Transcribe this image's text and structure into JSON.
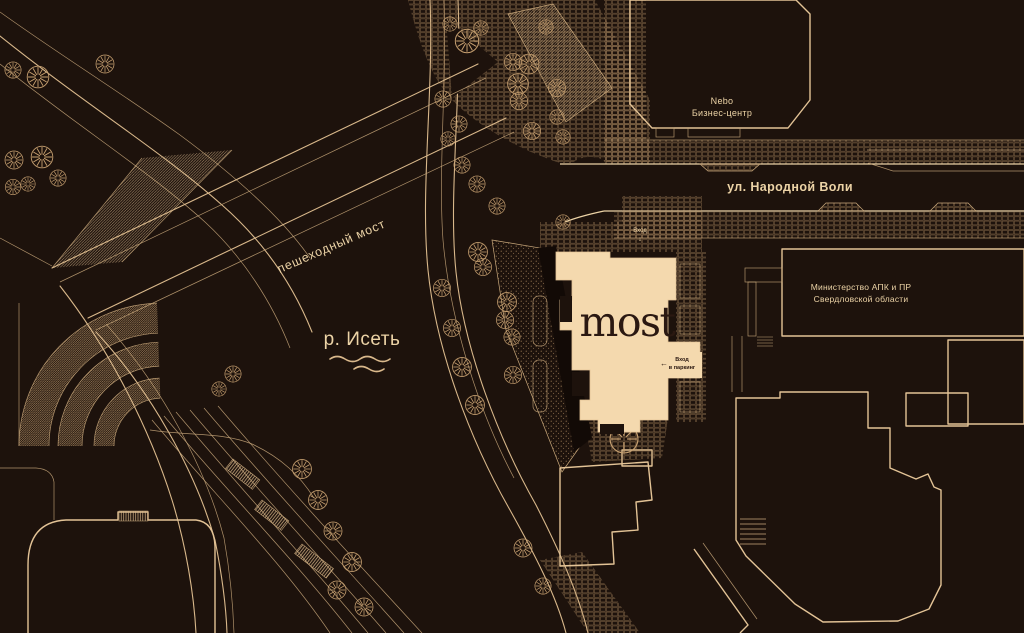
{
  "map": {
    "labels": {
      "street": "ул. Народной Воли",
      "bridge": "пешеходный мост",
      "river": "р. Исеть",
      "nebo_line1": "Nebo",
      "nebo_line2": "Бизнес-центр",
      "ministry_line1": "Министерство АПК и ПР",
      "ministry_line2": "Свердловской области",
      "logo": "most",
      "entrance": "Вход",
      "entrance_arrow": "↓",
      "parking_line1": "Вход",
      "parking_line2": "в паркинг",
      "parking_arrow": "←"
    },
    "colors": {
      "background": "#1d120c",
      "line": "#d9b88b",
      "line_bright": "#ecd3a6",
      "building_fill": "#f4d9ae",
      "logo_text": "#2a1811"
    }
  }
}
